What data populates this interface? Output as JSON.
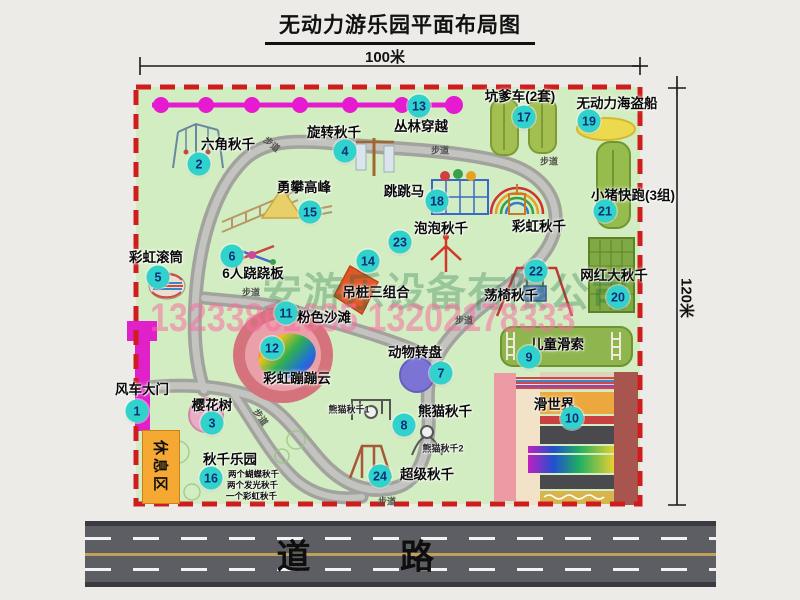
{
  "title": "无动力游乐园平面布局图",
  "dim_top": "100米",
  "dim_right": "120米",
  "road_label": "道  路",
  "rest_area": "休息区",
  "path_label": "步道",
  "rainbow_swing_label": "彩虹秋千",
  "panda_sub1": "熊猫秋千1",
  "panda_sub2": "熊猫秋千2",
  "swing_park_notes": [
    "两个蝴蝶秋千",
    "两个发光秋千",
    "一个彩虹秋千"
  ],
  "watermark": {
    "company": "安游乐设备有限公司",
    "phone": "13233861635 13202178333"
  },
  "attractions": [
    {
      "num": "1",
      "label": "风车大门"
    },
    {
      "num": "2",
      "label": "六角秋千"
    },
    {
      "num": "3",
      "label": "樱花树"
    },
    {
      "num": "4",
      "label": "旋转秋千"
    },
    {
      "num": "5",
      "label": "彩虹滚筒"
    },
    {
      "num": "6",
      "label": "6人跷跷板"
    },
    {
      "num": "7",
      "label": "动物转盘"
    },
    {
      "num": "8",
      "label": "熊猫秋千"
    },
    {
      "num": "9",
      "label": "儿童滑索"
    },
    {
      "num": "10",
      "label": "滑世界"
    },
    {
      "num": "11",
      "label": "粉色沙滩"
    },
    {
      "num": "12",
      "label": "彩虹蹦蹦云"
    },
    {
      "num": "13",
      "label": "丛林穿越"
    },
    {
      "num": "14",
      "label": "吊桩三组合"
    },
    {
      "num": "15",
      "label": "勇攀高峰"
    },
    {
      "num": "16",
      "label": "秋千乐园"
    },
    {
      "num": "17",
      "label": "坑爹车(2套)"
    },
    {
      "num": "18",
      "label": "跳跳马"
    },
    {
      "num": "19",
      "label": "无动力海盗船"
    },
    {
      "num": "20",
      "label": "网红大秋千"
    },
    {
      "num": "21",
      "label": "小猪快跑(3组)"
    },
    {
      "num": "22",
      "label": "荡椅秋千"
    },
    {
      "num": "23",
      "label": "泡泡秋千"
    },
    {
      "num": "24",
      "label": "超级秋千"
    }
  ],
  "colors": {
    "map_bg": "#d3edc2",
    "border_red": "#cf1d1d",
    "marker_bg": "#2fd3cc",
    "marker_text": "#0d2f7a",
    "zipline": "#e61ad0",
    "road": "#5d5d64",
    "rest_area": "#f5a832"
  }
}
